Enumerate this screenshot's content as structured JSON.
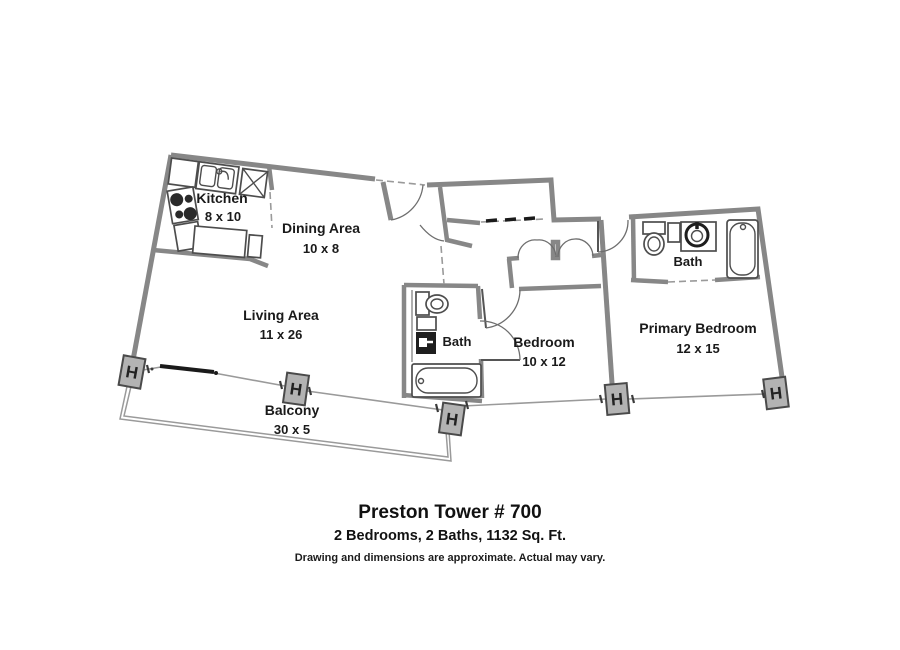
{
  "plan": {
    "rooms": [
      {
        "id": "kitchen",
        "name": "Kitchen",
        "dims": "8 x 10"
      },
      {
        "id": "dining-area",
        "name": "Dining Area",
        "dims": "10 x 8"
      },
      {
        "id": "living-area",
        "name": "Living Area",
        "dims": "11 x 26"
      },
      {
        "id": "bath",
        "name": "Bath"
      },
      {
        "id": "bedroom",
        "name": "Bedroom",
        "dims": "10 x 12"
      },
      {
        "id": "primary-bath",
        "name": "Bath"
      },
      {
        "id": "primary-bedroom",
        "name": "Primary Bedroom",
        "dims": "12 x 15"
      },
      {
        "id": "balcony",
        "name": "Balcony",
        "dims": "30 x 5"
      }
    ],
    "column_symbol": "H"
  },
  "footer": {
    "title": "Preston Tower # 700",
    "subtitle": "2 Bedrooms, 2 Baths, 1132 Sq. Ft.",
    "disclaimer": "Drawing and dimensions are approximate. Actual may vary."
  },
  "colors": {
    "background": "#ffffff",
    "wall": "#878787",
    "fixture_line": "#4d4d4d",
    "fixture_dark": "#1e1e1e",
    "column_fill": "#b3b3b3",
    "text": "#1a1a1a"
  }
}
